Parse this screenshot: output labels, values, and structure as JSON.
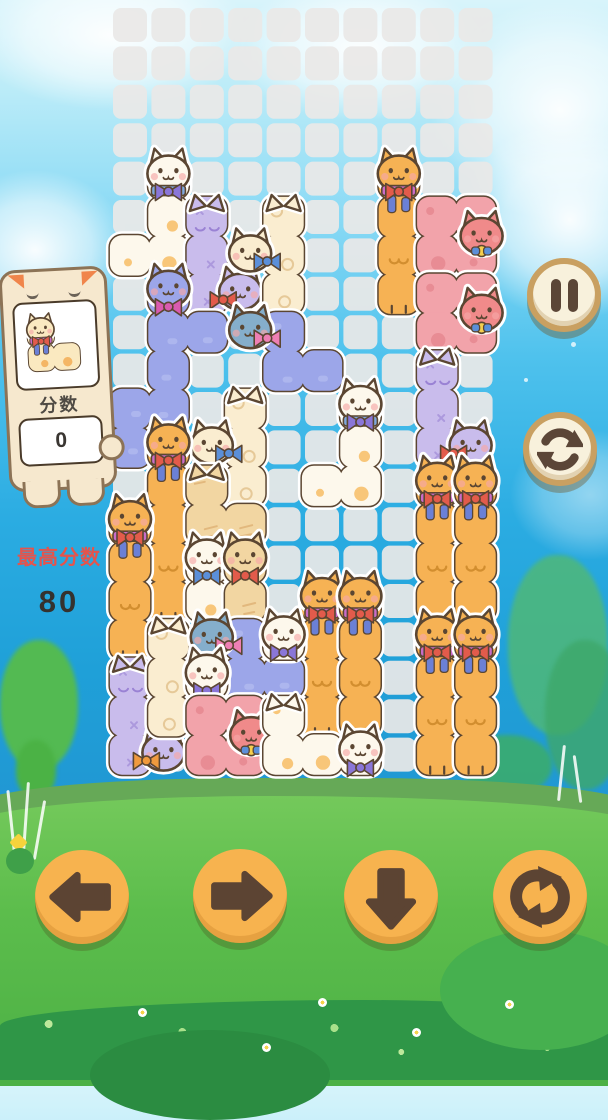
{
  "score_panel": {
    "label": "分数",
    "value": "0"
  },
  "best_score": {
    "label": "最高分数",
    "value": "80"
  },
  "board": {
    "cols": 10,
    "rows": 20,
    "ox": 113,
    "oy": 8,
    "pitch": 38.4,
    "cell": 34,
    "cell_color": "#E9E8E7",
    "cell_opacity": 0.93
  },
  "palette": {
    "outline": "#5B4632",
    "whitespot": {
      "fill": "#FDF8EC",
      "deco": "#F6B95C"
    },
    "cream": {
      "fill": "#FAEDD0",
      "deco": "#E2C28E"
    },
    "cream2": {
      "fill": "#FAE9C0",
      "deco": "#F2A94E"
    },
    "orange": {
      "fill": "#F6B254",
      "deco": "#D28E2F"
    },
    "lavender": {
      "fill": "#C9BCEC",
      "deco": "#9A82D4"
    },
    "periwinkle": {
      "fill": "#9CA6E9",
      "deco": "#BCC2F2"
    },
    "pink": {
      "fill": "#F2A3AA",
      "deco": "#E5868F"
    },
    "tan": {
      "fill": "#F2D6A2",
      "deco": "#DFB174"
    },
    "teal": {
      "fill": "#85AECB"
    },
    "salmon": {
      "fill": "#F08A8A"
    }
  },
  "bows": {
    "purple": "#8A76D8",
    "red": "#E25B4B",
    "blue": "#5B8FD9",
    "magenta": "#D95BB0",
    "pink": "#EE7FB4",
    "orange": "#F09A3E"
  },
  "pieces": [
    {
      "id": "white-j-1",
      "color": "whitespot",
      "cells": [
        [
          1,
          4
        ],
        [
          1,
          5
        ],
        [
          1,
          6
        ],
        [
          0,
          6
        ]
      ],
      "heads": [
        {
          "c": 1,
          "r": 4,
          "side": "up",
          "bow": "purple",
          "band": "#7FA8DC"
        }
      ]
    },
    {
      "id": "lav-l-1",
      "color": "lavender",
      "cells": [
        [
          2,
          5
        ],
        [
          2,
          6
        ],
        [
          2,
          7
        ]
      ],
      "heads": [
        {
          "c": 2,
          "r": 5,
          "style": "ears"
        },
        {
          "c": 3,
          "r": 7,
          "side": "left",
          "bow": "red",
          "color": "lavender"
        }
      ]
    },
    {
      "id": "cream-t-1",
      "color": "cream",
      "cells": [
        [
          4,
          5
        ],
        [
          4,
          6
        ],
        [
          4,
          7
        ]
      ],
      "heads": [
        {
          "c": 4,
          "r": 5,
          "style": "ears"
        },
        {
          "c": 3,
          "r": 6,
          "side": "right",
          "bow": "blue"
        }
      ]
    },
    {
      "id": "peri-z-1",
      "color": "periwinkle",
      "cells": [
        [
          1,
          7
        ],
        [
          1,
          8
        ],
        [
          2,
          8
        ],
        [
          1,
          9
        ],
        [
          1,
          10
        ],
        [
          0,
          10
        ],
        [
          0,
          11
        ]
      ],
      "heads": [
        {
          "c": 1,
          "r": 7,
          "side": "up",
          "bow": "magenta"
        }
      ]
    },
    {
      "id": "orange-i-1",
      "color": "orange",
      "cells": [
        [
          7,
          4
        ],
        [
          7,
          5
        ],
        [
          7,
          6
        ],
        [
          7,
          7
        ]
      ],
      "heads": [
        {
          "c": 7,
          "r": 4,
          "side": "up",
          "bow": "red",
          "band": "#C96CC9",
          "ribbon": true
        }
      ]
    },
    {
      "id": "pink-c-1",
      "color": "pink",
      "cells": [
        [
          8,
          5
        ],
        [
          9,
          5
        ],
        [
          8,
          6
        ],
        [
          9,
          6
        ]
      ],
      "heads": [
        {
          "c": 9,
          "r": 5,
          "side": "mid",
          "bow": "blue",
          "color": "salmon"
        }
      ]
    },
    {
      "id": "pink-c-2",
      "color": "pink",
      "cells": [
        [
          8,
          7
        ],
        [
          9,
          7
        ],
        [
          8,
          8
        ],
        [
          9,
          8
        ]
      ],
      "heads": [
        {
          "c": 9,
          "r": 7,
          "side": "mid",
          "bow": "blue",
          "color": "salmon"
        }
      ]
    },
    {
      "id": "teal-s-1",
      "color": "periwinkle",
      "cells": [
        [
          4,
          8
        ],
        [
          4,
          9
        ],
        [
          5,
          9
        ]
      ],
      "heads": [
        {
          "c": 3,
          "r": 8,
          "side": "right",
          "bow": "pink",
          "color": "teal"
        }
      ]
    },
    {
      "id": "white-j-2",
      "color": "whitespot",
      "cells": [
        [
          6,
          10
        ],
        [
          6,
          11
        ],
        [
          6,
          12
        ],
        [
          5,
          12
        ]
      ],
      "heads": [
        {
          "c": 6,
          "r": 10,
          "side": "up",
          "bow": "purple",
          "band": "#7FA8DC"
        }
      ]
    },
    {
      "id": "lav-l-2",
      "color": "lavender",
      "cells": [
        [
          8,
          9
        ],
        [
          8,
          10
        ],
        [
          8,
          11
        ]
      ],
      "heads": [
        {
          "c": 8,
          "r": 9,
          "style": "ears"
        },
        {
          "c": 9,
          "r": 11,
          "side": "left",
          "bow": "red",
          "color": "lavender"
        }
      ]
    },
    {
      "id": "cream-t-2",
      "color": "cream",
      "cells": [
        [
          3,
          10
        ],
        [
          3,
          11
        ],
        [
          3,
          12
        ]
      ],
      "heads": [
        {
          "c": 3,
          "r": 10,
          "style": "ears"
        },
        {
          "c": 2,
          "r": 11,
          "side": "right",
          "bow": "blue"
        }
      ]
    },
    {
      "id": "orange-i-2",
      "color": "orange",
      "cells": [
        [
          1,
          11
        ],
        [
          1,
          12
        ],
        [
          1,
          13
        ],
        [
          1,
          14
        ],
        [
          1,
          15
        ]
      ],
      "heads": [
        {
          "c": 1,
          "r": 11,
          "side": "up",
          "bow": "red",
          "band": "#C96CC9",
          "ribbon": true
        }
      ]
    },
    {
      "id": "orange-i-3",
      "color": "orange",
      "cells": [
        [
          0,
          13
        ],
        [
          0,
          14
        ],
        [
          0,
          15
        ],
        [
          0,
          16
        ]
      ],
      "heads": [
        {
          "c": 0,
          "r": 13,
          "side": "up",
          "bow": "red",
          "band": "#C96CC9",
          "ribbon": true
        }
      ]
    },
    {
      "id": "tan-s-1",
      "color": "tan",
      "cells": [
        [
          2,
          12
        ],
        [
          2,
          13
        ],
        [
          3,
          13
        ]
      ],
      "heads": [
        {
          "c": 2,
          "r": 12,
          "style": "ears"
        }
      ]
    },
    {
      "id": "white-i-sm",
      "color": "whitespot",
      "cells": [
        [
          2,
          14
        ],
        [
          2,
          15
        ]
      ],
      "heads": [
        {
          "c": 2,
          "r": 14,
          "side": "up",
          "bow": "blue"
        }
      ]
    },
    {
      "id": "tan-i-sm",
      "color": "tan",
      "cells": [
        [
          3,
          14
        ],
        [
          3,
          15
        ]
      ],
      "heads": [
        {
          "c": 3,
          "r": 14,
          "side": "up",
          "bow": "red"
        }
      ]
    },
    {
      "id": "orange-i-4",
      "color": "orange",
      "cells": [
        [
          5,
          15
        ],
        [
          5,
          16
        ],
        [
          5,
          17
        ],
        [
          5,
          18
        ]
      ],
      "heads": [
        {
          "c": 5,
          "r": 15,
          "side": "up",
          "bow": "red",
          "band": "#C96CC9",
          "ribbon": true
        }
      ]
    },
    {
      "id": "orange-i-5",
      "color": "orange",
      "cells": [
        [
          6,
          15
        ],
        [
          6,
          16
        ],
        [
          6,
          17
        ],
        [
          6,
          18
        ]
      ],
      "heads": [
        {
          "c": 6,
          "r": 15,
          "side": "up",
          "bow": "red",
          "band": "#C96CC9",
          "ribbon": true
        }
      ]
    },
    {
      "id": "orange-i-6",
      "color": "orange",
      "cells": [
        [
          8,
          12
        ],
        [
          8,
          13
        ],
        [
          8,
          14
        ],
        [
          8,
          15
        ]
      ],
      "heads": [
        {
          "c": 8,
          "r": 12,
          "side": "up",
          "bow": "red",
          "band": "#C96CC9",
          "ribbon": true
        }
      ]
    },
    {
      "id": "orange-i-7",
      "color": "orange",
      "cells": [
        [
          9,
          12
        ],
        [
          9,
          13
        ],
        [
          9,
          14
        ],
        [
          9,
          15
        ]
      ],
      "heads": [
        {
          "c": 9,
          "r": 12,
          "side": "up",
          "bow": "red",
          "band": "#C96CC9",
          "ribbon": true
        }
      ]
    },
    {
      "id": "orange-i-8",
      "color": "orange",
      "cells": [
        [
          8,
          16
        ],
        [
          8,
          17
        ],
        [
          8,
          18
        ],
        [
          8,
          19
        ]
      ],
      "heads": [
        {
          "c": 8,
          "r": 16,
          "side": "up",
          "bow": "red",
          "band": "#C96CC9",
          "ribbon": true
        }
      ]
    },
    {
      "id": "orange-i-9",
      "color": "orange",
      "cells": [
        [
          9,
          16
        ],
        [
          9,
          17
        ],
        [
          9,
          18
        ],
        [
          9,
          19
        ]
      ],
      "heads": [
        {
          "c": 9,
          "r": 16,
          "side": "up",
          "bow": "red",
          "band": "#C96CC9",
          "ribbon": true
        }
      ]
    },
    {
      "id": "lav-l-3",
      "color": "lavender",
      "cells": [
        [
          0,
          17
        ],
        [
          0,
          18
        ],
        [
          0,
          19
        ]
      ],
      "heads": [
        {
          "c": 0,
          "r": 17,
          "style": "ears"
        },
        {
          "c": 1,
          "r": 19,
          "side": "left",
          "bow": "orange",
          "color": "lavender"
        }
      ]
    },
    {
      "id": "cream-i-3",
      "color": "cream",
      "cells": [
        [
          1,
          16
        ],
        [
          1,
          17
        ],
        [
          1,
          18
        ]
      ],
      "heads": [
        {
          "c": 1,
          "r": 16,
          "style": "ears"
        }
      ]
    },
    {
      "id": "peri-z-2",
      "color": "periwinkle",
      "cells": [
        [
          3,
          16
        ],
        [
          3,
          17
        ],
        [
          4,
          17
        ]
      ],
      "heads": [
        {
          "c": 2,
          "r": 16,
          "side": "right",
          "bow": "pink",
          "color": "teal"
        }
      ]
    },
    {
      "id": "white-head-1",
      "color": "whitespot",
      "cells": [
        [
          4,
          16
        ]
      ],
      "heads": [
        {
          "c": 4,
          "r": 16,
          "side": "up",
          "bow": "purple"
        }
      ]
    },
    {
      "id": "white-head-2",
      "color": "whitespot",
      "cells": [
        [
          2,
          17
        ]
      ],
      "heads": [
        {
          "c": 2,
          "r": 17,
          "side": "up",
          "bow": "purple"
        }
      ]
    },
    {
      "id": "pink-c-3",
      "color": "pink",
      "cells": [
        [
          2,
          18
        ],
        [
          3,
          18
        ],
        [
          2,
          19
        ],
        [
          3,
          19
        ]
      ],
      "heads": [
        {
          "c": 3,
          "r": 18,
          "side": "mid",
          "bow": "blue",
          "color": "salmon"
        }
      ]
    },
    {
      "id": "white-l-4",
      "color": "whitespot",
      "cells": [
        [
          4,
          18
        ],
        [
          4,
          19
        ],
        [
          5,
          19
        ],
        [
          6,
          19
        ]
      ],
      "heads": [
        {
          "c": 4,
          "r": 18,
          "style": "ears"
        },
        {
          "c": 6,
          "r": 19,
          "side": "up",
          "bow": "purple"
        }
      ]
    }
  ],
  "preview_piece": {
    "id": "next",
    "color": "cream2",
    "cells": [
      [
        0,
        0
      ],
      [
        0,
        1
      ],
      [
        1,
        1
      ]
    ],
    "heads": [
      {
        "c": 0,
        "r": 0,
        "side": "up",
        "bow": "red",
        "band": "#C96CC9",
        "ribbon": true
      }
    ]
  }
}
